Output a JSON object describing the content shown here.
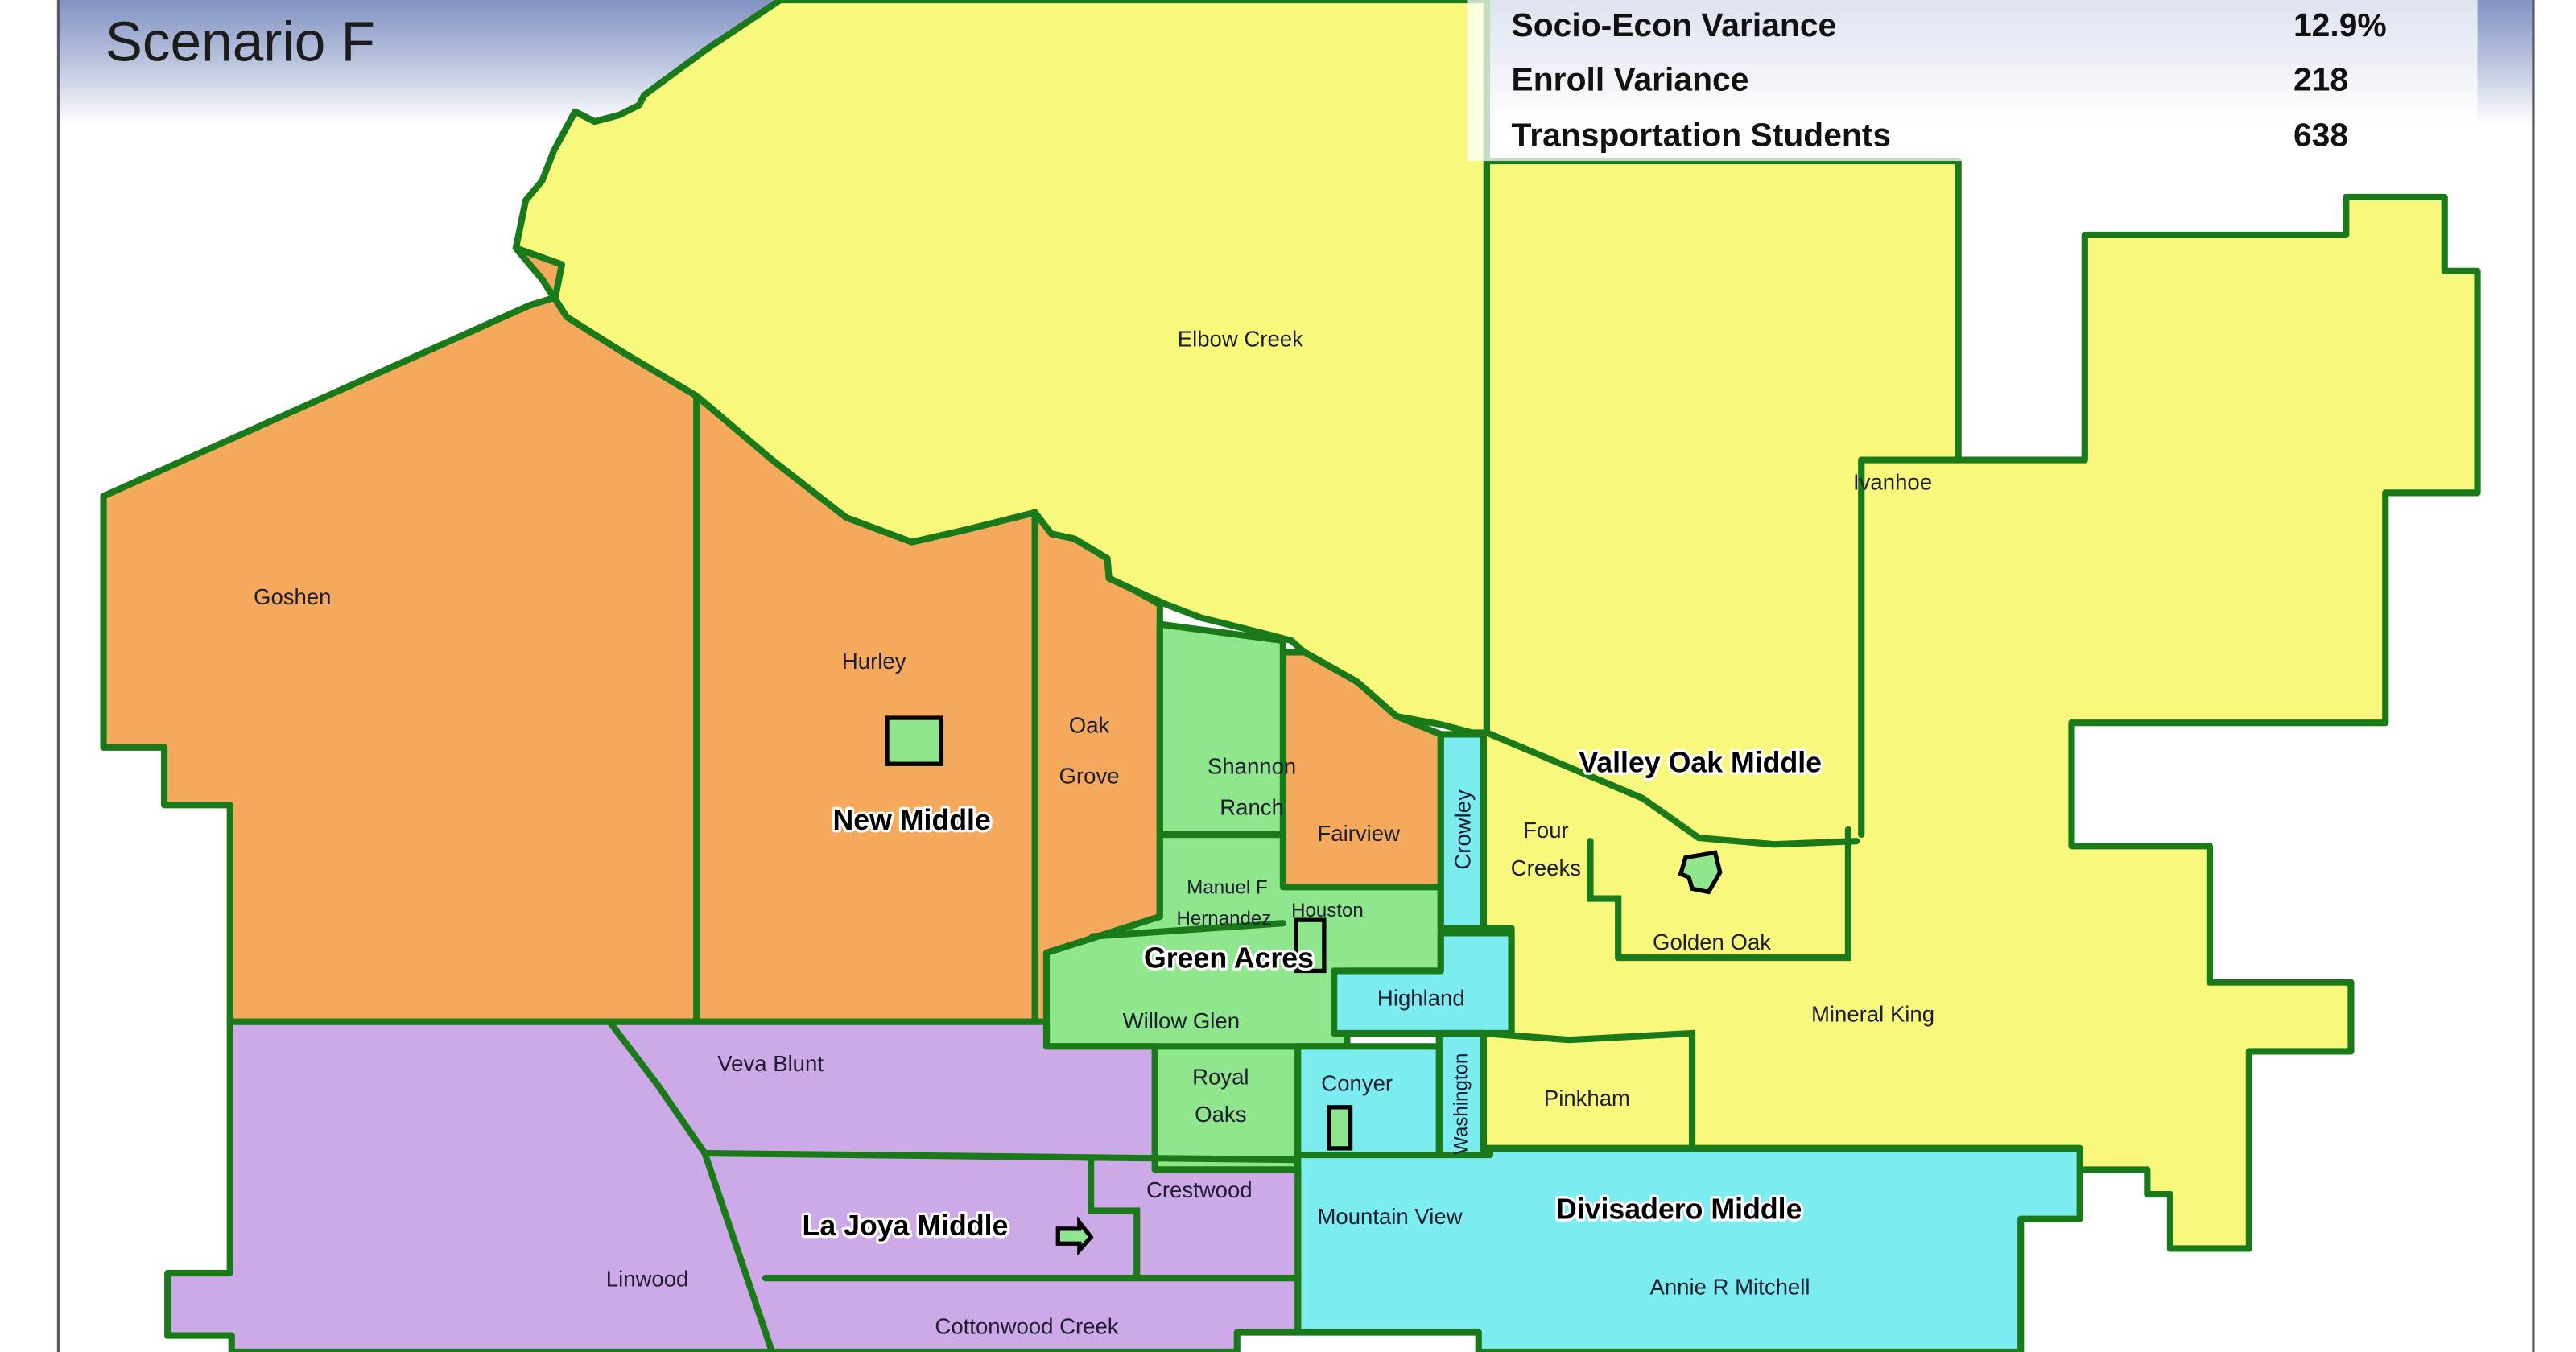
{
  "header": {
    "title": "Scenario F",
    "stats": [
      {
        "label": "Socio-Econ Variance",
        "value": "12.9%"
      },
      {
        "label": "Enroll Variance",
        "value": "218"
      },
      {
        "label": "Transportation Students",
        "value": "638"
      }
    ]
  },
  "map": {
    "border_color": "#1A7A1A",
    "frame_color": "#5a5a66",
    "gradient_top_color": "#8293C4",
    "zones": {
      "new_middle": {
        "label": "New Middle",
        "color": "#F5A95D"
      },
      "valley_oak_middle": {
        "label": "Valley Oak Middle",
        "color": "#F8F97C"
      },
      "green_acres": {
        "label": "Green Acres",
        "color": "#8FE68C"
      },
      "divisadero_middle": {
        "label": "Divisadero Middle",
        "color": "#7BEDF0"
      },
      "la_joya_middle": {
        "label": "La Joya Middle",
        "color": "#CDA9E8"
      }
    },
    "areas": {
      "goshen": "Goshen",
      "hurley": "Hurley",
      "elbow_creek": "Elbow Creek",
      "ivanhoe": "Ivanhoe",
      "oak_grove": [
        "Oak",
        "Grove"
      ],
      "shannon_ranch": [
        "Shannon",
        "Ranch"
      ],
      "manuel_f_hernandez": [
        "Manuel F",
        "Hernandez"
      ],
      "fairview": "Fairview",
      "houston": "Houston",
      "crowley": "Crowley",
      "four_creeks": [
        "Four",
        "Creeks"
      ],
      "golden_oak": "Golden Oak",
      "mineral_king": "Mineral King",
      "willow_glen": "Willow Glen",
      "highland": "Highland",
      "royal_oaks": [
        "Royal",
        "Oaks"
      ],
      "conyer": "Conyer",
      "washington": "Washington",
      "pinkham": "Pinkham",
      "veva_blunt": "Veva Blunt",
      "crestwood": "Crestwood",
      "linwood": "Linwood",
      "cottonwood_creek": "Cottonwood Creek",
      "mountain_view": "Mountain View",
      "annie_r_mitchell": "Annie R Mitchell",
      "divisadero_middle": "Divisadero Middle"
    },
    "icons": {
      "new_middle_site": "proposed-school-site",
      "golden_oak_school": "school-site",
      "hernandez_school": "school-site",
      "conyer_school": "school-site",
      "la_joya_school": "school-site"
    }
  }
}
